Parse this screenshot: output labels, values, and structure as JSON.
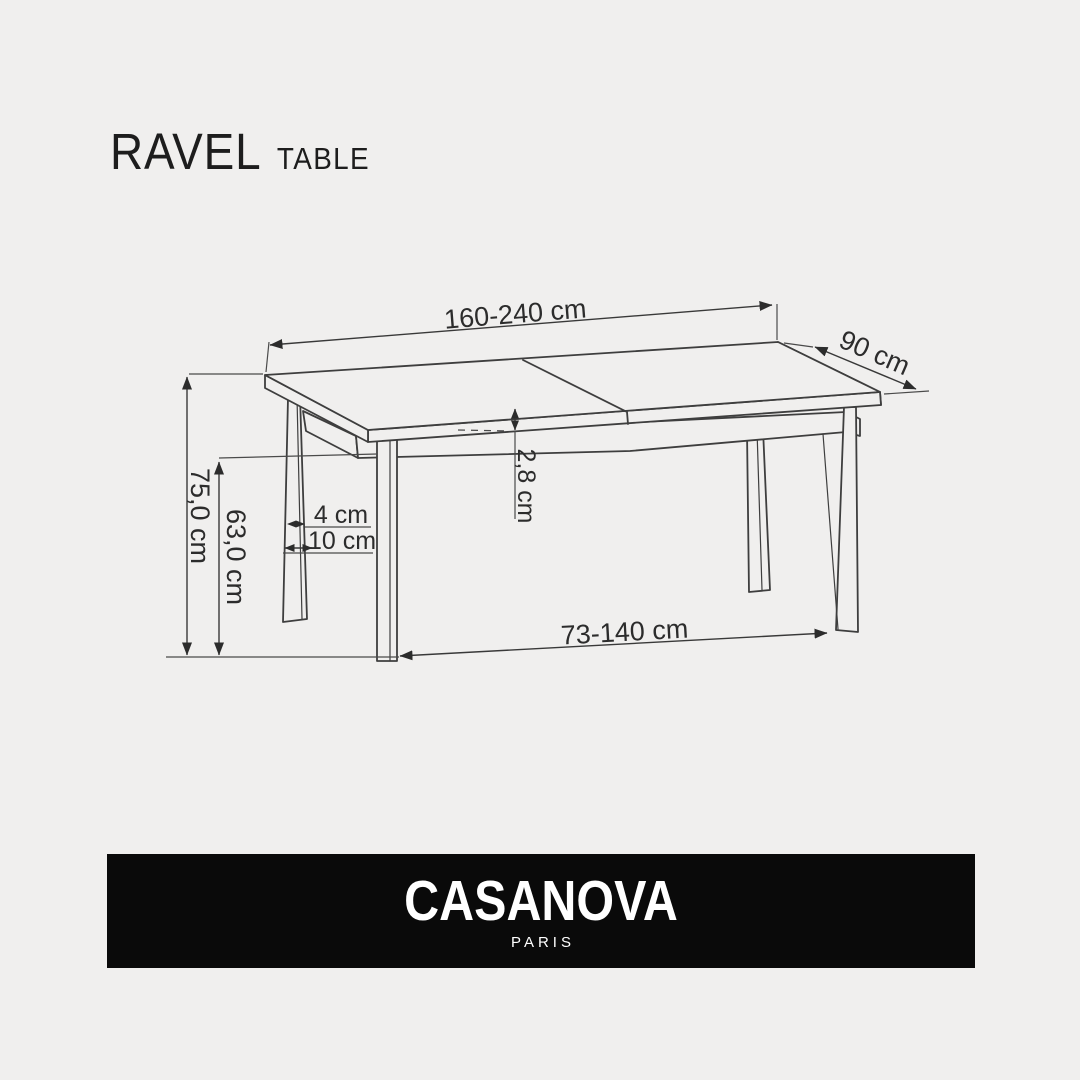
{
  "colors": {
    "background": "#f0efee",
    "drawing_line": "#3e3e3e",
    "banner_background": "#0a0a0a",
    "banner_text": "#ffffff"
  },
  "header": {
    "product_name": "RAVEL",
    "product_category": "TABLE"
  },
  "diagram": {
    "labels": {
      "top_width": "160-240 cm",
      "depth": "90 cm",
      "total_height": "75,0 cm",
      "clearance_height": "63,0 cm",
      "leg_thickness": "4 cm",
      "leg_offset": "10 cm",
      "tabletop_thickness": "2,8 cm",
      "leg_distance": "73-140 cm"
    }
  },
  "footer": {
    "brand_name": "CASANOVA",
    "brand_city": "PARIS"
  }
}
